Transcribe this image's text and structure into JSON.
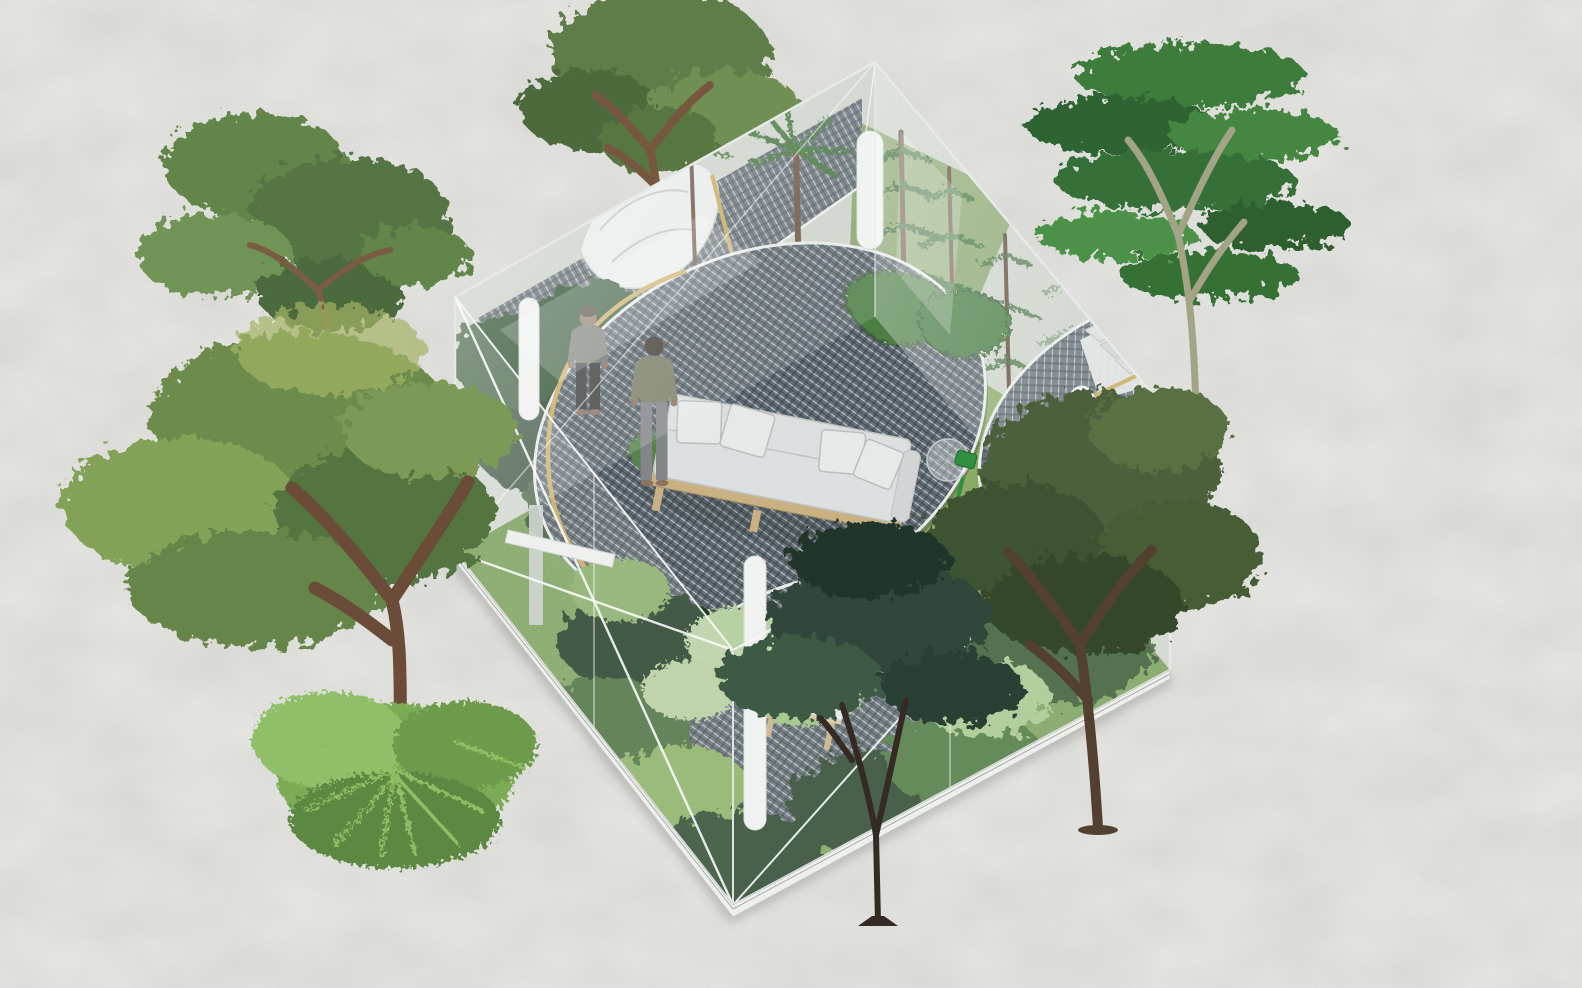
{
  "scene": {
    "type": "architectural-axonometric-collage",
    "description": "Cut-away axonometric rendering of an open-top glass box house densely planted as a tropical garden. Circular steel-mesh decks float over ferns, calatheas and lawn; a white daybed sofa, a tufted bench, a sculpted white lounger, slender white columns, a green pedestal fan and two standing men occupy the interior. Seven cut-out trees and a fern mound surround the box on a mottled grey paper background.",
    "people": [
      "man standing on mesh deck facing viewer, grey t-shirt, dark trousers",
      "man standing with back turned, olive t-shirt, grey trousers, barefoot"
    ],
    "furniture": [
      "wood-framed daybed sofa with four white cushions",
      "white tufted bench with timber legs",
      "sculpted white lounger on upper mesh ledge"
    ],
    "equipment": [
      "green pedestal fan",
      "second green floor fan"
    ],
    "structure": {
      "walls": "four frameless glass walls with cable X-bracing",
      "decks": "three circular grating decks with timber trim",
      "columns": "slender white cylindrical columns",
      "base": "thin white plinth band"
    },
    "trees_outside": [
      "airy tree top-left",
      "large spreading tree left",
      "fern mound lower-left",
      "tree top-centre behind roof edge",
      "tall layered rain tree top-right",
      "dark olive tree over right corner",
      "slim dark tree over bottom corner"
    ],
    "plants_inside": [
      "palms",
      "norfolk pines",
      "tree ferns",
      "calathea",
      "taro leaves",
      "lawn"
    ]
  },
  "palette": {
    "paper": "#d9d9d5",
    "grass": "#7e9c5a",
    "grass_light": "#8aa964",
    "mesh_base": "#67717a",
    "deck_rim": "#e9ece9",
    "trim_wood": "#c9a957",
    "glass_edge": "#e6e9e8",
    "sofa_cushion": "#dcdfdf",
    "sofa_pillow": "#e6e9e8",
    "wood_frame": "#c9b183",
    "column_white": "#f0f2f0",
    "fan_green": "#2f9040",
    "bench_white": "#eef0ee",
    "plinth": "#eef0ee",
    "foliage_dark": "#2c452e",
    "foliage_mid": "#4a7a42",
    "foliage_light": "#8cb468",
    "fern_sage": "#b8d1a2"
  }
}
